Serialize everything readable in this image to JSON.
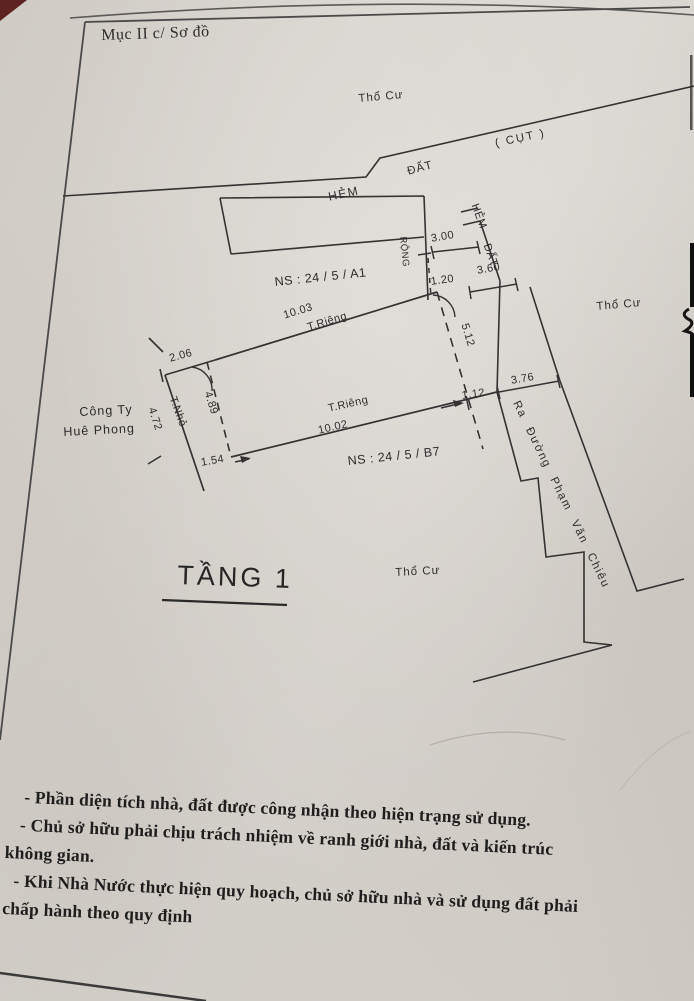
{
  "page": {
    "header": "Mục II c/ Sơ đồ",
    "notes": [
      "- Phần diện tích nhà, đất được công nhận theo hiện trạng sử dụng.",
      "- Chủ sở hữu phải chịu trách nhiệm về ranh giới nhà, đất và kiến trúc",
      "không gian.",
      "- Khi Nhà Nước thực hiện quy hoạch, chủ sở hữu nhà và sử dụng đất phải",
      "chấp hành theo quy định"
    ]
  },
  "diagram": {
    "floor_title": "TẦNG 1",
    "areas": {
      "tho_cu_top": "Thổ Cư",
      "tho_cu_right": "Thổ Cư",
      "tho_cu_bottom": "Thổ Cư",
      "dat": "ĐẤT",
      "cut": "( CỤT )",
      "hem": "HẺM",
      "hem_vertical": "HẺM",
      "dat_vertical": "ĐẤT",
      "rong": "RỘNG",
      "cong_ty_line1": "Công Ty",
      "cong_ty_line2": "Huê Phong",
      "ns_a1": "NS : 24 / 5 / A1",
      "ns_b7": "NS : 24 / 5 / B7",
      "road": "Ra Đường Phạm Văn Chiêu"
    },
    "dimensions": {
      "d300": "3.00",
      "d360": "3.60",
      "d120": "1.20",
      "d512": "5.12",
      "d376": "3.76",
      "d112": "1.12",
      "d206": "2.06",
      "d1003": "10.03",
      "d1002": "10.02",
      "d472": "4.72",
      "d489": "4.89",
      "d154": "1.54",
      "t_rieng_top": "T.Riêng",
      "t_rieng_mid": "T.Riêng",
      "t_nho": "T.Nhỏ"
    }
  },
  "colors": {
    "paper": "#d6d2cc",
    "ink": "#333333",
    "page_corner": "#5d2320"
  }
}
